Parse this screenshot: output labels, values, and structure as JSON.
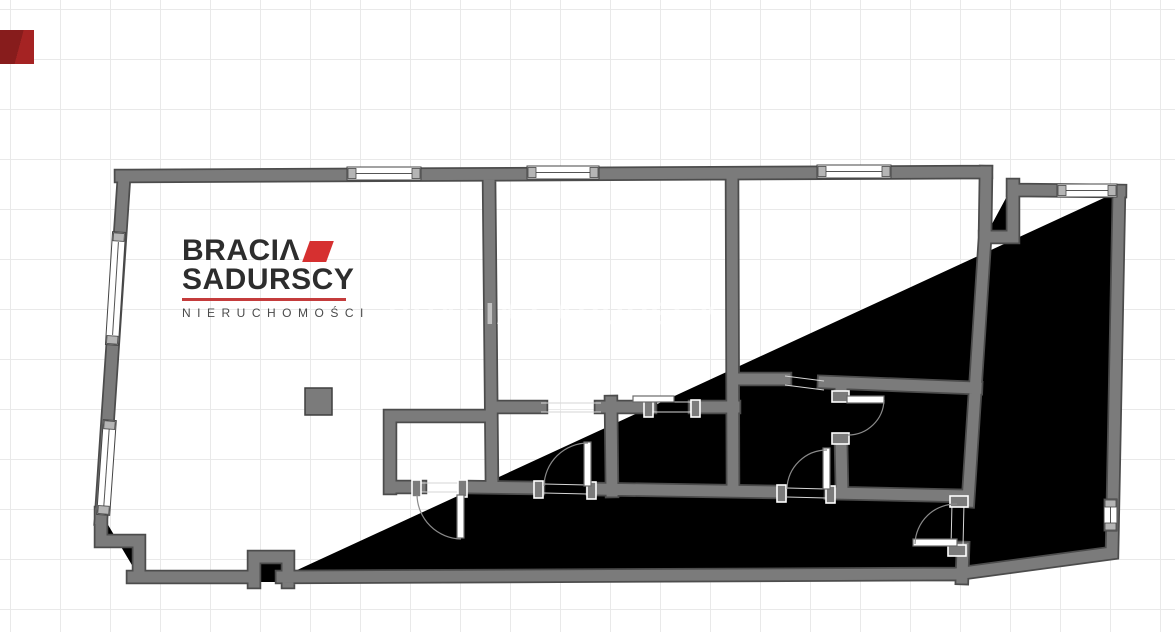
{
  "brand": {
    "line1": "BRACI",
    "line1_mark": "Λ",
    "line2": "SADURSCY",
    "tagline": "NIERUCHOMOŚCI",
    "accent_color": "#d63030",
    "rule_color": "#c43c3c",
    "text_color": "#2d2d2d"
  },
  "watermark": {
    "text": "BRACIA SADURSCY"
  },
  "corner_square": {
    "color": "#8e1e1e"
  },
  "plan": {
    "background_color": "#ffffff",
    "grid_color": "#e9e9e9",
    "wall_fill_color": "#7b7b7b",
    "wall_outline_color": "#4c4c4c",
    "window_fill_color": "#ffffff",
    "stairs_fill_color": "#f6f2d0",
    "stairs": {
      "left_flight_direction": "down",
      "right_flight_direction": "up"
    }
  }
}
